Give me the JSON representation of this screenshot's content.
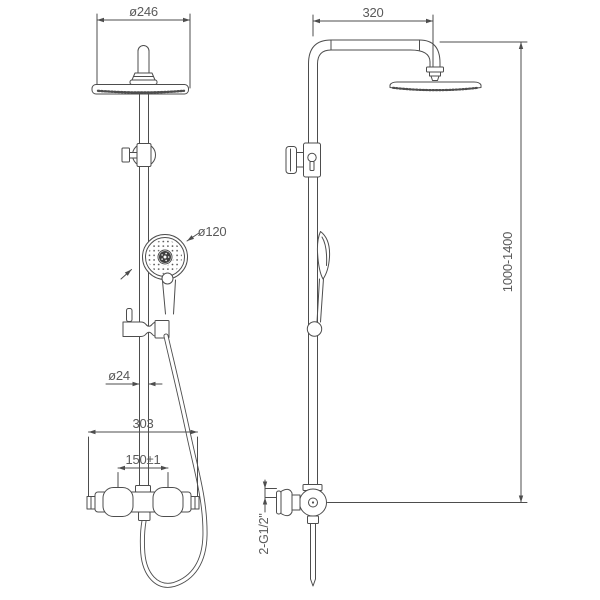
{
  "colors": {
    "line": "#4d4d4d",
    "text": "#5a5a5a",
    "background": "#ffffff"
  },
  "front_view": {
    "dim_head_diameter": "ø246",
    "dim_hand_shower_diameter": "ø120",
    "dim_pipe_diameter": "ø24",
    "dim_mixer_width": "303",
    "dim_inlet_spacing": "150±1"
  },
  "side_view": {
    "dim_arm_projection": "320",
    "dim_height_range": "1000-1400",
    "dim_connections": "2-G1/2\""
  }
}
